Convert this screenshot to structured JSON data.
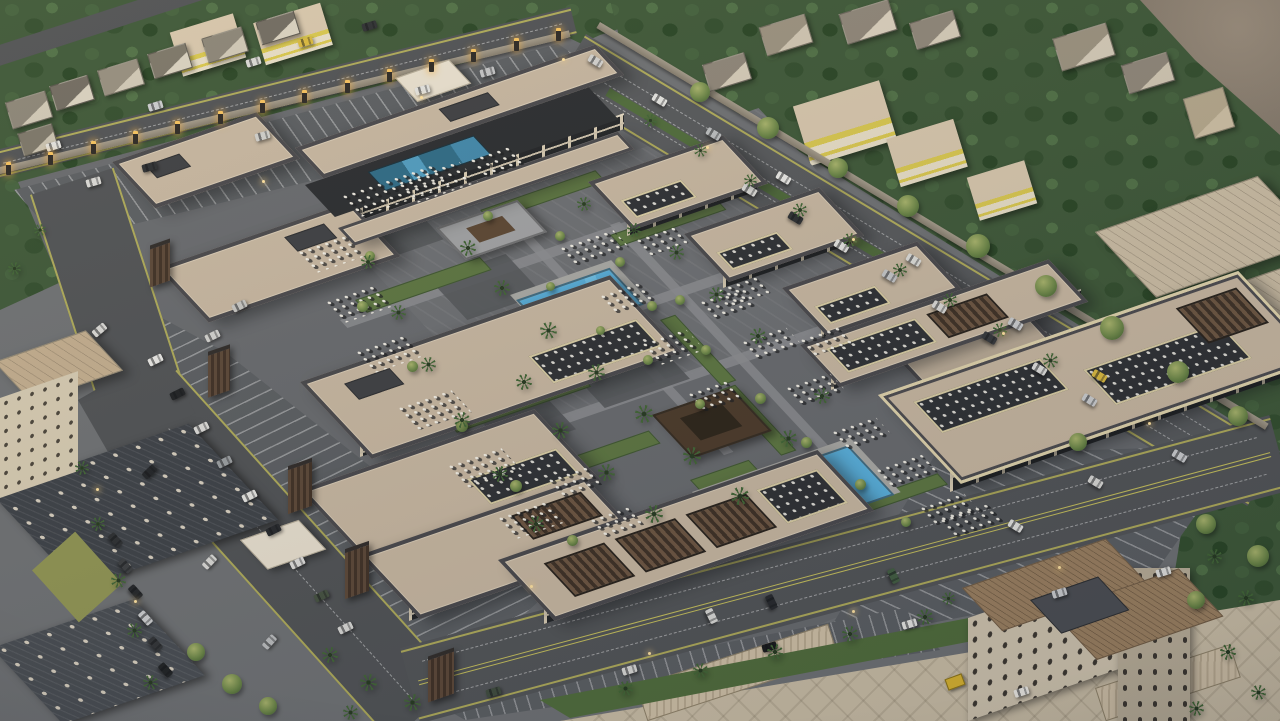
{
  "scene": {
    "type": "aerial-3d-architectural-rendering",
    "subject": "Dusk aerial rendering of a retail plaza complex: rows of flat-roofed shop buildings around a central promenade with two blue pools, palm trees, umbrella dining clusters, perimeter parking lots, a lit boundary wall, surrounded by tree-filled neighborhoods and streets",
    "time_of_day": "dusk",
    "palette": {
      "asphalt": "#4e5154",
      "parking": "#595d61",
      "paving": "#6b6e72",
      "roof_tan": "#c6b6a0",
      "roof_border": "#47474b",
      "wall_beige": "#e6dcc6",
      "storefront_dark": "#202326",
      "wood_brown": "#5a4636",
      "pergola_brown": "#4a3929",
      "pool_blue": "#57b0dd",
      "terrace_pool_teal": "#2c6a86",
      "grass": "#5b7540",
      "tree_green": "#3c5737",
      "palm_green": "#3f6434",
      "lane_yellow": "#c6c05a",
      "pillar_glow": "#f7c35e",
      "dirt": "#8d8275",
      "hotel_beige": "#cfc4ae",
      "hotel_roof": "#9a7f5f",
      "shop_yellow": "#d8c74e"
    },
    "counts": {
      "retail_buildings": 12,
      "ground_pools": 2,
      "rooftop_pools": 1,
      "pavilions": 2,
      "lit_wall_pillars": 14,
      "parking_lots": 4,
      "roads": 4
    },
    "pillars": {
      "x1": 6,
      "y1": 162,
      "x2": 556,
      "y2": 28,
      "count": 14
    },
    "cars": [
      [
        148,
        356,
        -26,
        "#e9e9e6"
      ],
      [
        170,
        390,
        -26,
        "#1d2023"
      ],
      [
        194,
        424,
        -26,
        "#dcdcd9"
      ],
      [
        217,
        458,
        -26,
        "#9a9ea1"
      ],
      [
        242,
        492,
        -26,
        "#e6e6e3"
      ],
      [
        266,
        526,
        -26,
        "#24272b"
      ],
      [
        290,
        559,
        -26,
        "#dedddb"
      ],
      [
        314,
        592,
        -26,
        "#43503f"
      ],
      [
        205,
        332,
        -26,
        "#d2d2cf"
      ],
      [
        232,
        302,
        -26,
        "#c6c6c3"
      ],
      [
        338,
        624,
        -26,
        "#d8d8d5"
      ],
      [
        86,
        178,
        -16,
        "#dadad7"
      ],
      [
        142,
        163,
        -16,
        "#2b2e31"
      ],
      [
        255,
        132,
        -16,
        "#cfcfcc"
      ],
      [
        415,
        86,
        -16,
        "#e3e3e0"
      ],
      [
        480,
        68,
        -16,
        "#c2c4c6"
      ],
      [
        652,
        96,
        31,
        "#e6e6e3"
      ],
      [
        706,
        130,
        31,
        "#babdbf"
      ],
      [
        776,
        174,
        31,
        "#e9e9e6"
      ],
      [
        906,
        256,
        31,
        "#dbdbd8"
      ],
      [
        1008,
        320,
        31,
        "#caccce"
      ],
      [
        1092,
        372,
        31,
        "#d9b93d"
      ],
      [
        588,
        57,
        31,
        "#d2d2cf"
      ],
      [
        742,
        186,
        31,
        "#dadad7"
      ],
      [
        788,
        214,
        31,
        "#2b2e31"
      ],
      [
        834,
        242,
        31,
        "#e4e4e1"
      ],
      [
        882,
        272,
        31,
        "#c3c5c7"
      ],
      [
        932,
        303,
        31,
        "#d9d9d6"
      ],
      [
        982,
        334,
        31,
        "#34373b"
      ],
      [
        1032,
        365,
        31,
        "#e0e0dd"
      ],
      [
        1082,
        396,
        31,
        "#caccce"
      ],
      [
        622,
        666,
        -17,
        "#d9d9d6"
      ],
      [
        762,
        643,
        -17,
        "#17191b"
      ],
      [
        902,
        620,
        -17,
        "#e5e5e2"
      ],
      [
        1052,
        589,
        -17,
        "#cbcdcf"
      ],
      [
        1156,
        568,
        -17,
        "#e1e1de"
      ],
      [
        486,
        688,
        -17,
        "#3e4b3d"
      ],
      [
        704,
        612,
        64,
        "#d9d9d6"
      ],
      [
        764,
        598,
        64,
        "#24272b"
      ],
      [
        886,
        572,
        64,
        "#405c40"
      ],
      [
        1008,
        522,
        31,
        "#e3e3e0"
      ],
      [
        1088,
        478,
        31,
        "#d9d9d6"
      ],
      [
        1172,
        452,
        31,
        "#cbcdcf"
      ],
      [
        92,
        326,
        -40,
        "#d9d9d6"
      ],
      [
        142,
        468,
        -44,
        "#202326"
      ],
      [
        202,
        558,
        -46,
        "#d9d9d6"
      ],
      [
        262,
        638,
        -48,
        "#b9bbbd"
      ],
      [
        108,
        536,
        48,
        "#2b2e31"
      ],
      [
        118,
        562,
        48,
        "#3b3e41"
      ],
      [
        128,
        588,
        48,
        "#222528"
      ],
      [
        138,
        614,
        48,
        "#cbcdcf"
      ],
      [
        148,
        640,
        48,
        "#2f3235"
      ],
      [
        158,
        666,
        48,
        "#1d2022"
      ],
      [
        298,
        38,
        -17,
        "#d9b93d"
      ],
      [
        246,
        58,
        -17,
        "#d9d9d6"
      ],
      [
        148,
        102,
        -17,
        "#caccce"
      ],
      [
        46,
        142,
        -17,
        "#e3e3e0"
      ],
      [
        362,
        22,
        -17,
        "#2b2e31"
      ],
      [
        1014,
        688,
        -18,
        "#eceae4"
      ]
    ],
    "palms": [
      [
        468,
        248,
        16
      ],
      [
        502,
        288,
        16
      ],
      [
        548,
        330,
        17
      ],
      [
        596,
        372,
        17
      ],
      [
        644,
        414,
        18
      ],
      [
        692,
        456,
        18
      ],
      [
        740,
        496,
        18
      ],
      [
        788,
        438,
        17
      ],
      [
        822,
        396,
        16
      ],
      [
        758,
        336,
        16
      ],
      [
        716,
        294,
        15
      ],
      [
        676,
        252,
        15
      ],
      [
        560,
        430,
        17
      ],
      [
        606,
        472,
        17
      ],
      [
        654,
        514,
        18
      ],
      [
        524,
        382,
        16
      ],
      [
        584,
        204,
        14
      ],
      [
        634,
        230,
        14
      ],
      [
        368,
        262,
        14
      ],
      [
        398,
        312,
        15
      ],
      [
        428,
        364,
        15
      ],
      [
        462,
        420,
        16
      ],
      [
        500,
        474,
        16
      ],
      [
        536,
        524,
        16
      ],
      [
        650,
        120,
        13
      ],
      [
        700,
        150,
        13
      ],
      [
        750,
        180,
        13
      ],
      [
        800,
        210,
        14
      ],
      [
        850,
        240,
        14
      ],
      [
        900,
        270,
        14
      ],
      [
        950,
        300,
        14
      ],
      [
        1000,
        330,
        14
      ],
      [
        1050,
        360,
        15
      ],
      [
        625,
        688,
        15
      ],
      [
        700,
        670,
        15
      ],
      [
        775,
        652,
        16
      ],
      [
        850,
        634,
        16
      ],
      [
        925,
        617,
        16
      ],
      [
        82,
        468,
        14
      ],
      [
        98,
        524,
        14
      ],
      [
        118,
        580,
        15
      ],
      [
        134,
        630,
        15
      ],
      [
        150,
        682,
        15
      ],
      [
        330,
        655,
        16
      ],
      [
        368,
        682,
        17
      ],
      [
        412,
        702,
        17
      ],
      [
        350,
        712,
        15
      ],
      [
        1214,
        556,
        15
      ],
      [
        1246,
        598,
        16
      ],
      [
        1228,
        652,
        16
      ],
      [
        1258,
        692,
        15
      ],
      [
        1196,
        708,
        15
      ],
      [
        948,
        598,
        13
      ],
      [
        14,
        268,
        13
      ],
      [
        40,
        230,
        12
      ]
    ],
    "trees": [
      [
        362,
        306,
        11
      ],
      [
        412,
        366,
        11
      ],
      [
        462,
        426,
        12
      ],
      [
        516,
        486,
        12
      ],
      [
        572,
        540,
        11
      ],
      [
        652,
        306,
        10
      ],
      [
        706,
        350,
        10
      ],
      [
        760,
        398,
        11
      ],
      [
        806,
        442,
        11
      ],
      [
        860,
        484,
        11
      ],
      [
        906,
        522,
        10
      ],
      [
        488,
        216,
        10
      ],
      [
        560,
        236,
        10
      ],
      [
        620,
        262,
        10
      ],
      [
        680,
        300,
        10
      ],
      [
        370,
        256,
        10
      ],
      [
        648,
        360,
        10
      ],
      [
        700,
        404,
        10
      ],
      [
        550,
        286,
        9
      ],
      [
        600,
        330,
        9
      ],
      [
        700,
        92,
        20
      ],
      [
        768,
        128,
        22
      ],
      [
        838,
        168,
        20
      ],
      [
        908,
        206,
        22
      ],
      [
        978,
        246,
        24
      ],
      [
        1046,
        286,
        22
      ],
      [
        1112,
        328,
        24
      ],
      [
        1178,
        372,
        22
      ],
      [
        1238,
        416,
        20
      ],
      [
        1078,
        442,
        18
      ],
      [
        196,
        652,
        18
      ],
      [
        232,
        684,
        20
      ],
      [
        268,
        706,
        18
      ],
      [
        1206,
        524,
        20
      ],
      [
        1258,
        556,
        22
      ],
      [
        1196,
        600,
        18
      ]
    ],
    "dining_clusters": [
      [
        298,
        252,
        52,
        26
      ],
      [
        326,
        302,
        50,
        26
      ],
      [
        356,
        352,
        52,
        26
      ],
      [
        398,
        408,
        56,
        28
      ],
      [
        448,
        466,
        56,
        28
      ],
      [
        498,
        518,
        50,
        26
      ],
      [
        398,
        182,
        64,
        26
      ],
      [
        342,
        196,
        96,
        26
      ],
      [
        470,
        160,
        40,
        22
      ],
      [
        560,
        248,
        56,
        24
      ],
      [
        600,
        296,
        44,
        24
      ],
      [
        642,
        344,
        46,
        26
      ],
      [
        688,
        394,
        40,
        24
      ],
      [
        700,
        302,
        44,
        22
      ],
      [
        742,
        342,
        46,
        24
      ],
      [
        786,
        388,
        46,
        24
      ],
      [
        832,
        432,
        46,
        24
      ],
      [
        876,
        470,
        48,
        24
      ],
      [
        920,
        508,
        46,
        22
      ],
      [
        548,
        480,
        40,
        22
      ],
      [
        590,
        520,
        40,
        22
      ],
      [
        940,
        520,
        50,
        22
      ],
      [
        636,
        240,
        40,
        20
      ],
      [
        718,
        290,
        40,
        20
      ],
      [
        800,
        340,
        40,
        20
      ]
    ],
    "street_lights": [
      [
        420,
        96
      ],
      [
        562,
        58
      ],
      [
        706,
        146
      ],
      [
        852,
        238
      ],
      [
        1002,
        332
      ],
      [
        1148,
        422
      ],
      [
        648,
        652
      ],
      [
        852,
        610
      ],
      [
        1058,
        566
      ],
      [
        96,
        488
      ],
      [
        134,
        600
      ],
      [
        262,
        180
      ],
      [
        530,
        585
      ]
    ],
    "houses": [
      [
        8,
        96,
        40,
        26,
        "#8a8477",
        "#cfc8b6"
      ],
      [
        52,
        80,
        38,
        24,
        "#6f6a60",
        "#d8d1c0"
      ],
      [
        100,
        64,
        40,
        25,
        "#948d7e",
        "#cfc8b6"
      ],
      [
        150,
        48,
        38,
        24,
        "#7a7568",
        "#d8d1c0"
      ],
      [
        204,
        32,
        40,
        24,
        "#8a8477",
        "#cfc8b6"
      ],
      [
        258,
        16,
        38,
        22,
        "#6f6a60",
        "#d8d1c0"
      ],
      [
        20,
        128,
        34,
        22,
        "#7a7568",
        "#c9c2b0"
      ],
      [
        705,
        58,
        42,
        26,
        "#8d8578",
        "#d4cbb8"
      ],
      [
        762,
        20,
        46,
        28,
        "#9a917f",
        "#cfc6b2"
      ],
      [
        842,
        6,
        50,
        30,
        "#8d8578",
        "#d8cfbc"
      ],
      [
        1056,
        30,
        54,
        32,
        "#9a917f",
        "#d4cbb8"
      ],
      [
        1124,
        58,
        46,
        28,
        "#8d8578",
        "#cfc6b2"
      ],
      [
        1188,
        92,
        40,
        40,
        "#b5a88c",
        "#cdbfa4"
      ],
      [
        912,
        16,
        44,
        26,
        "#8d8578",
        "#d4cbb8"
      ]
    ]
  }
}
